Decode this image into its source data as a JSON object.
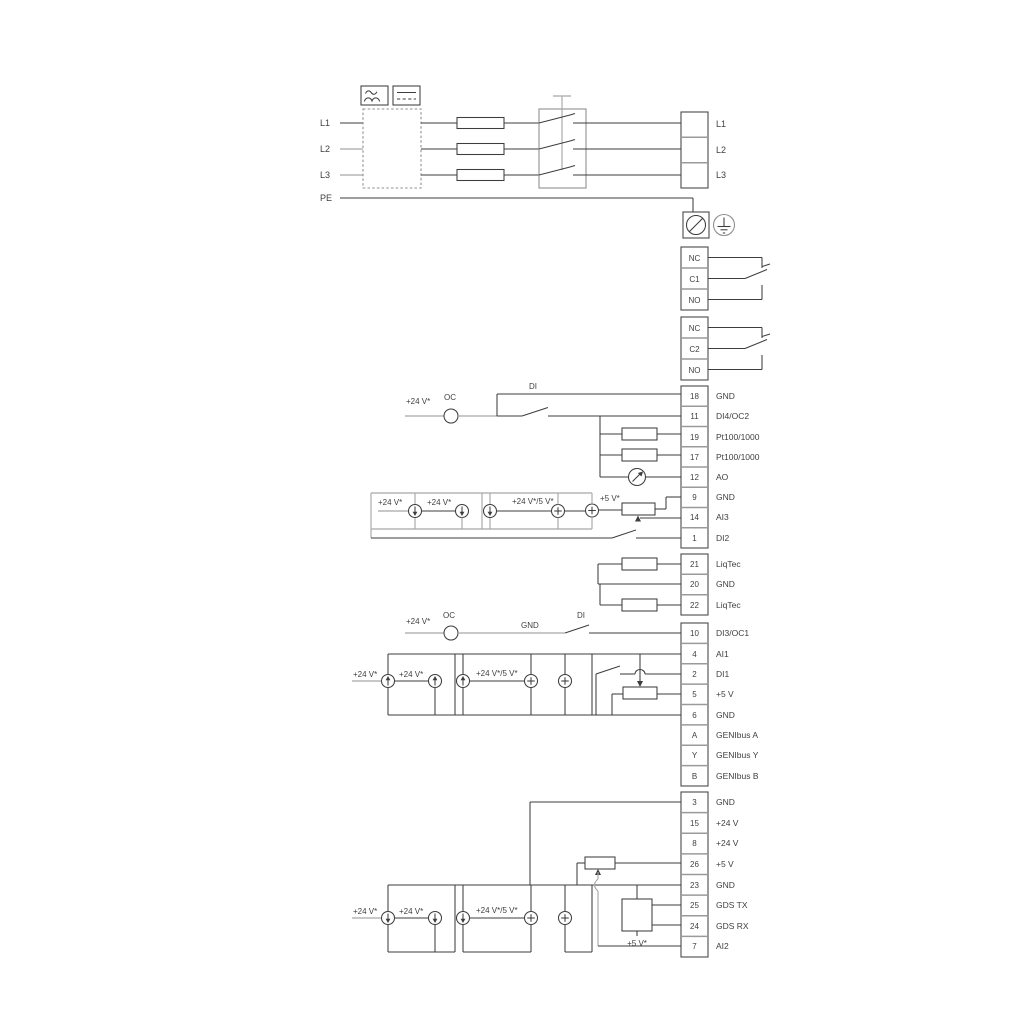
{
  "diagram": {
    "power": {
      "inputs": [
        "L1",
        "L2",
        "L3"
      ],
      "pe": "PE",
      "outputs": [
        "L1",
        "L2",
        "L3"
      ]
    },
    "relay1": {
      "terminals": [
        "NC",
        "C1",
        "NO"
      ]
    },
    "relay2": {
      "terminals": [
        "NC",
        "C2",
        "NO"
      ]
    },
    "io_group_1": {
      "terminals": [
        {
          "no": "18",
          "label": "GND"
        },
        {
          "no": "11",
          "label": "DI4/OC2"
        },
        {
          "no": "19",
          "label": "Pt100/1000"
        },
        {
          "no": "17",
          "label": "Pt100/1000"
        },
        {
          "no": "12",
          "label": "AO"
        },
        {
          "no": "9",
          "label": "GND"
        },
        {
          "no": "14",
          "label": "AI3"
        },
        {
          "no": "1",
          "label": "DI2"
        }
      ]
    },
    "io_group_2": {
      "terminals": [
        {
          "no": "21",
          "label": "LiqTec"
        },
        {
          "no": "20",
          "label": "GND"
        },
        {
          "no": "22",
          "label": "LiqTec"
        }
      ]
    },
    "io_group_3": {
      "terminals": [
        {
          "no": "10",
          "label": "DI3/OC1"
        },
        {
          "no": "4",
          "label": "AI1"
        },
        {
          "no": "2",
          "label": "DI1"
        },
        {
          "no": "5",
          "label": "+5 V"
        },
        {
          "no": "6",
          "label": "GND"
        },
        {
          "no": "A",
          "label": "GENIbus A"
        },
        {
          "no": "Y",
          "label": "GENIbus Y"
        },
        {
          "no": "B",
          "label": "GENIbus B"
        }
      ]
    },
    "io_group_4": {
      "terminals": [
        {
          "no": "3",
          "label": "GND"
        },
        {
          "no": "15",
          "label": "+24 V"
        },
        {
          "no": "8",
          "label": "+24 V"
        },
        {
          "no": "26",
          "label": "+5 V"
        },
        {
          "no": "23",
          "label": "GND"
        },
        {
          "no": "25",
          "label": "GDS TX"
        },
        {
          "no": "24",
          "label": "GDS RX"
        },
        {
          "no": "7",
          "label": "AI2"
        }
      ]
    },
    "annotations": {
      "v24": "+24 V*",
      "v24_5": "+24 V*/5 V*",
      "v5": "+5 V*",
      "oc": "OC",
      "di": "DI",
      "gnd": "GND"
    },
    "colors": {
      "line_dark": "#3d3d3d",
      "line_gray": "#a8a8a8"
    }
  }
}
